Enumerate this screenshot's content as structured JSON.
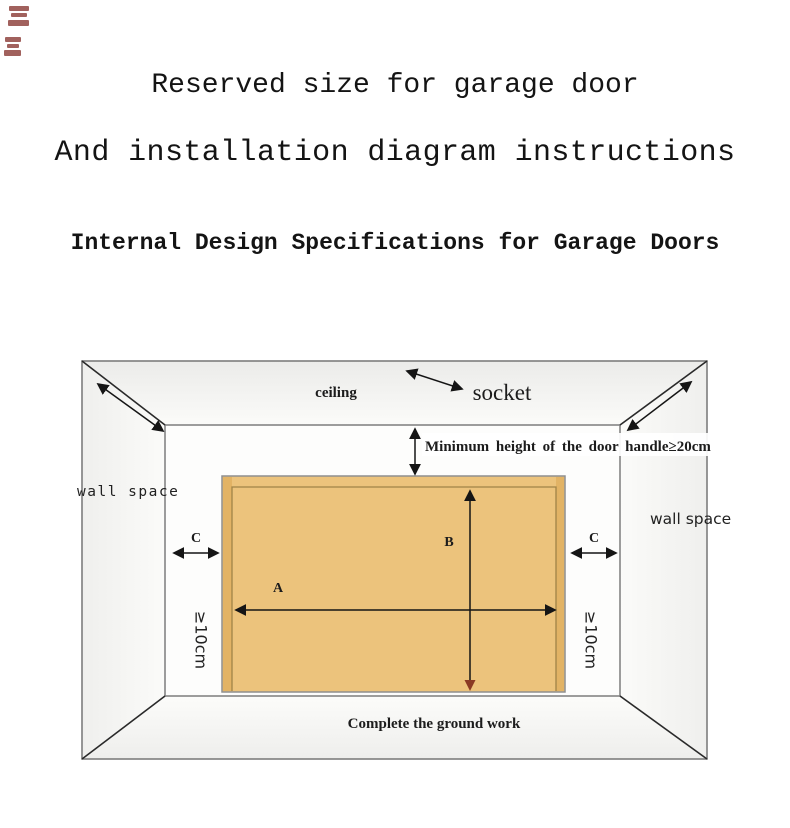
{
  "titles": {
    "line1": "Reserved size for garage door",
    "line2": "And installation diagram instructions",
    "line3": "Internal Design Specifications for Garage Doors"
  },
  "diagram": {
    "labels": {
      "ceiling": "ceiling",
      "socket": "socket",
      "min_height": "Minimum height of the door handle≥20cm",
      "wall_space_left": "wall space",
      "wall_space_right": "wall space",
      "clearance_left": "C",
      "clearance_right": "C",
      "width_label": "A",
      "height_label": "B",
      "side_min_left": "≥10cm",
      "side_min_right": "≥10cm",
      "ground": "Complete the ground work"
    },
    "colors": {
      "door_fill": "#ecc37c",
      "door_edge_strip": "#e2b365",
      "door_inner_line": "#a08347",
      "room_line": "#7d7d7d",
      "corner_line": "#2a2a2a",
      "arrow": "#151515",
      "bottom_arrowhead": "#8a3a24",
      "stamp": "#7a1f1a"
    }
  }
}
